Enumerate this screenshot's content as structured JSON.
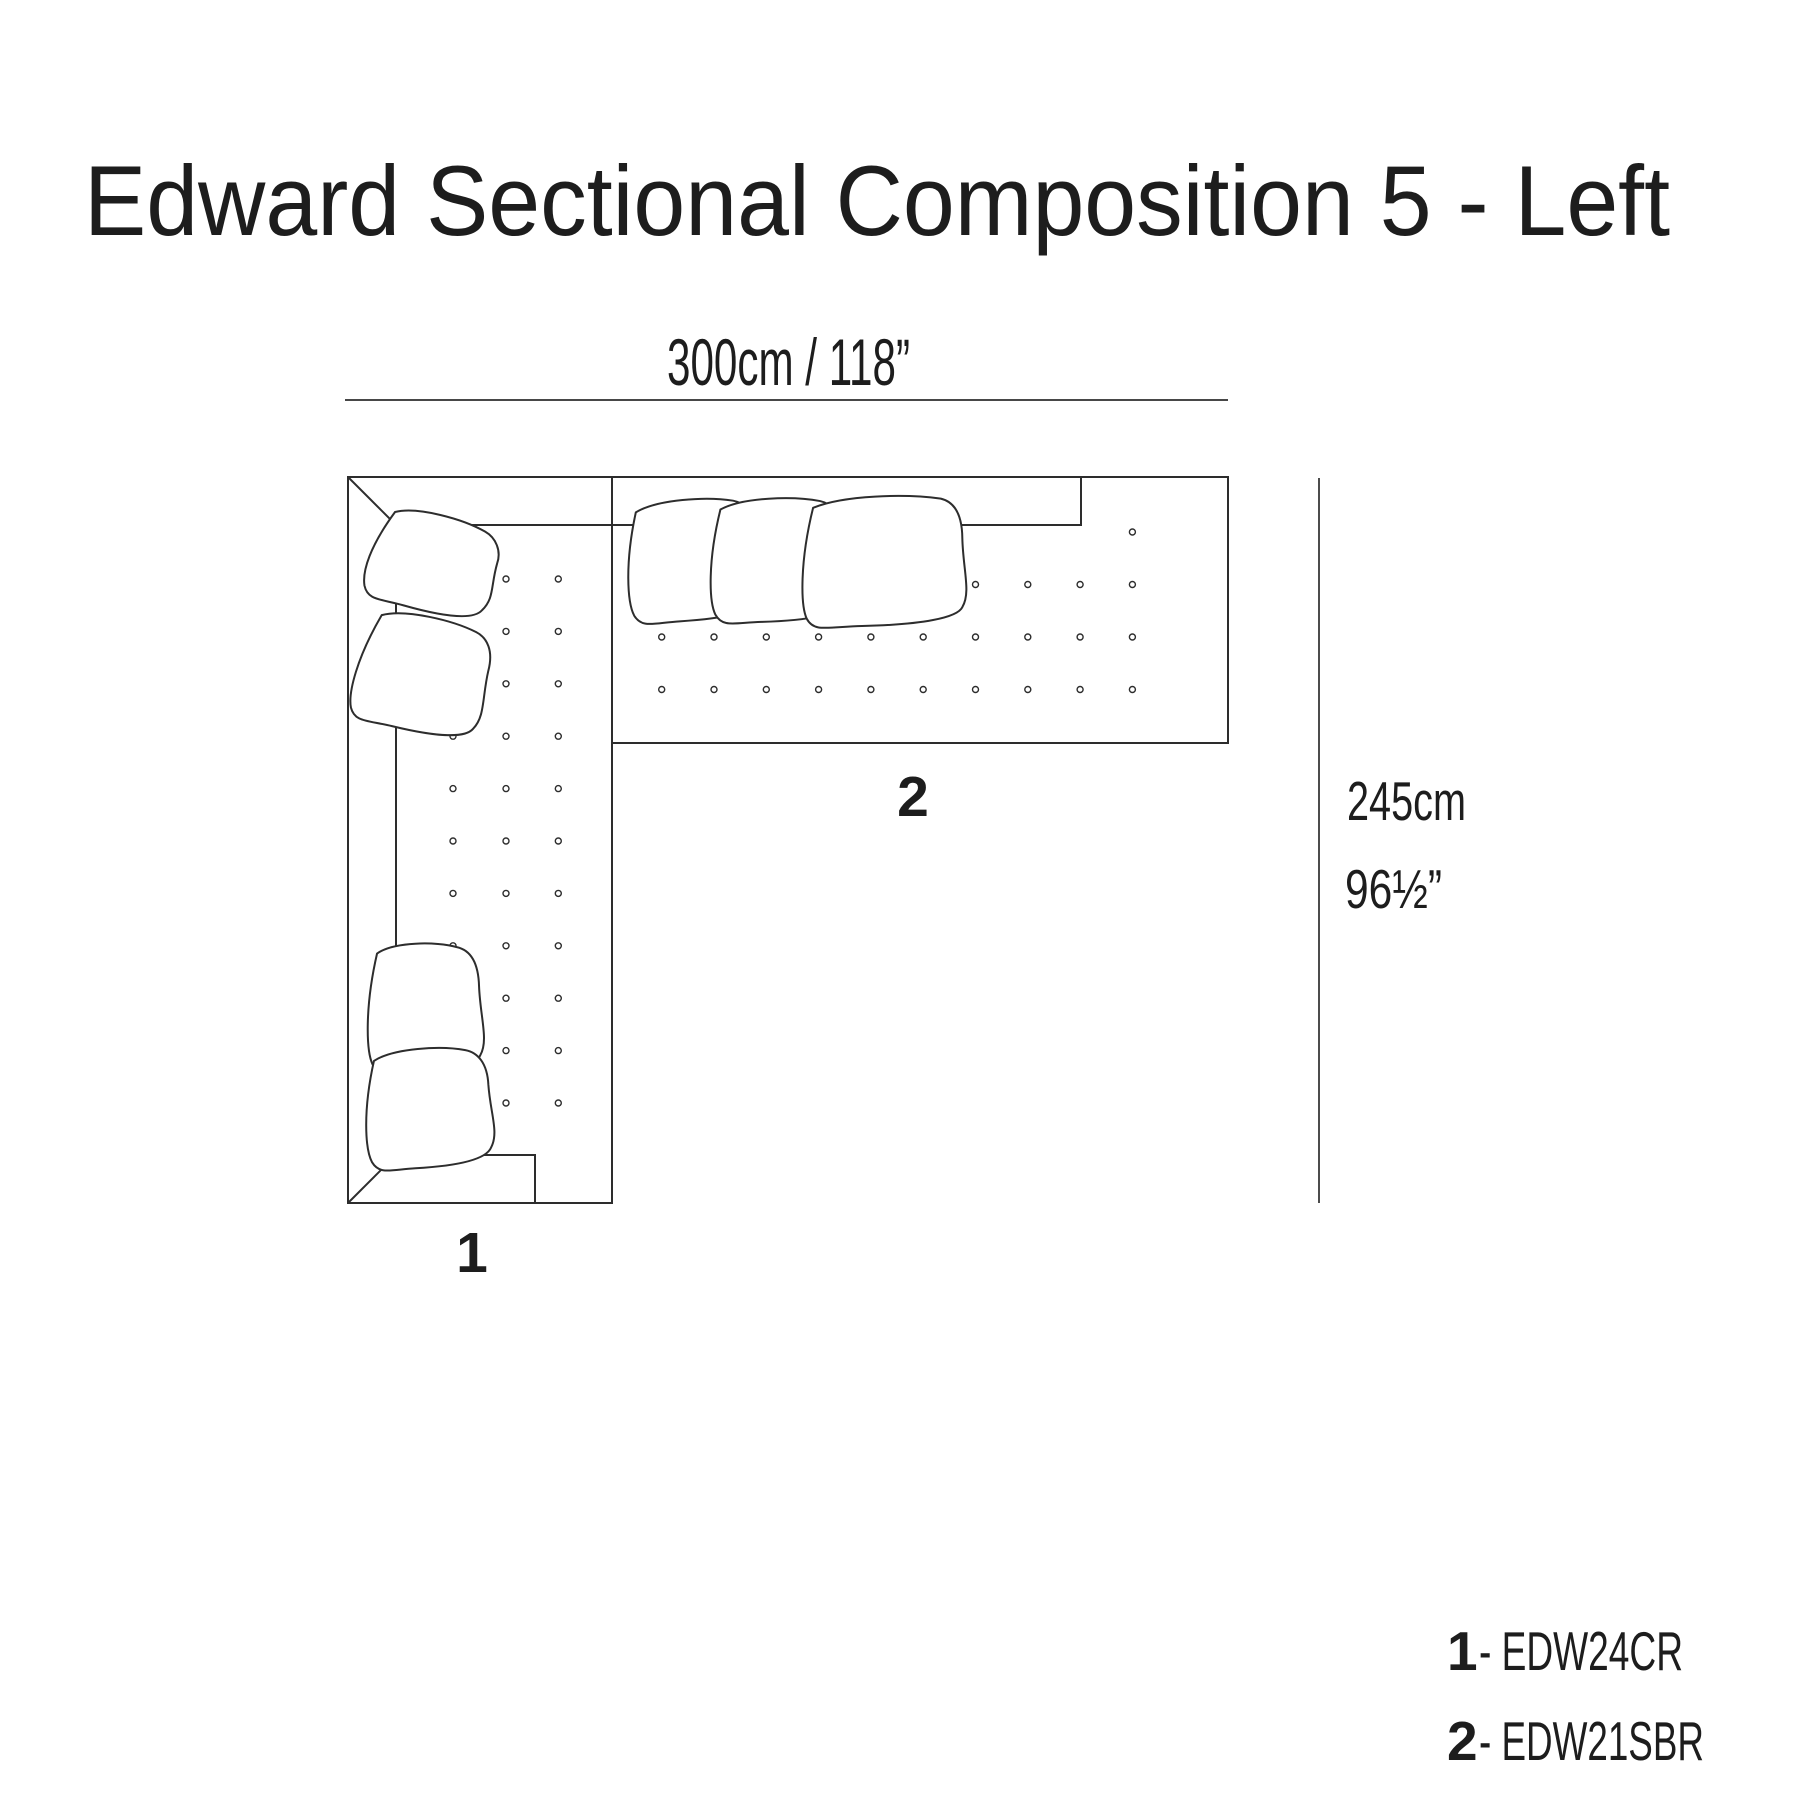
{
  "title": "Edward Sectional Composition 5 - Left",
  "dimensions": {
    "width": "300cm / 118”",
    "height_cm": "245cm",
    "height_in": "96½”"
  },
  "legend": {
    "items": [
      {
        "number": "1",
        "label": "- EDW24CR"
      },
      {
        "number": "2",
        "label": "- EDW21SBR"
      }
    ]
  },
  "colors": {
    "line": "#2d2d2d",
    "text": "#1d1d1d",
    "background": "#ffffff"
  }
}
